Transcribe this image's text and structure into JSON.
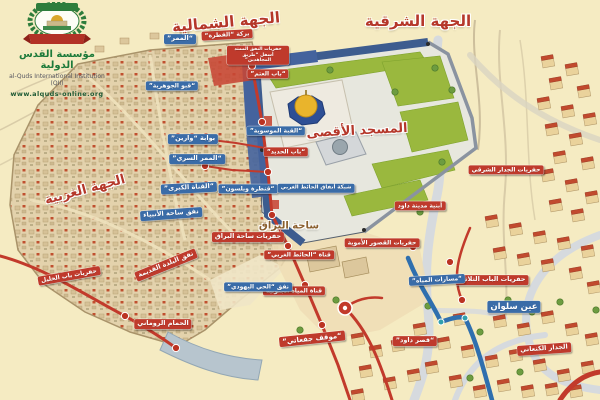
{
  "logo": {
    "org_name_ar": "مؤسسة القدس الدولية",
    "org_name_en": "al-Quds International Institution (QII)",
    "website": "www.alquds-online.org"
  },
  "headers": [
    {
      "id": "side-north",
      "text": "الجهة الشمالية",
      "x": 226,
      "y": 22,
      "rot": -5,
      "fs": 15
    },
    {
      "id": "side-east",
      "text": "الجهة الشرقية",
      "x": 418,
      "y": 21,
      "rot": 0,
      "fs": 15
    },
    {
      "id": "side-west",
      "text": "الجهة الغربية",
      "x": 85,
      "y": 190,
      "rot": -15,
      "fs": 13
    },
    {
      "id": "al-aqsa-mosque",
      "text": "المسجد الأقصى",
      "x": 357,
      "y": 131,
      "rot": -3,
      "fs": 13
    },
    {
      "id": "buraq-plaza",
      "text": "ساحة البراق",
      "x": 289,
      "y": 226,
      "rot": 0,
      "fs": 10,
      "color": "#8a5f2e"
    }
  ],
  "labels": [
    {
      "id": "birket-al-qatra",
      "text": "بركة “القطرة”",
      "color": "red",
      "x": 227,
      "y": 35,
      "rot": -3,
      "fs": 6
    },
    {
      "id": "north-tunnel-excavation",
      "text": "حفريات النفق الممتد أسفل “طريق المجاهدين”",
      "color": "red",
      "x": 258,
      "y": 55,
      "rot": 0,
      "fs": 4.6,
      "w": 56
    },
    {
      "id": "bab-al-atm",
      "text": "“باب العتم”",
      "color": "red",
      "x": 268,
      "y": 74,
      "rot": 0,
      "fs": 6
    },
    {
      "id": "bab-al-hadid",
      "text": "“باب الحديد”",
      "color": "red",
      "x": 286,
      "y": 152,
      "rot": 0,
      "fs": 6
    },
    {
      "id": "mosaic-dome",
      "text": "“القبة الموسوية”",
      "color": "blue",
      "x": 276,
      "y": 131,
      "rot": 0,
      "fs": 6
    },
    {
      "id": "buraq-plaza-excavations",
      "text": "حفريات ساحة البراق",
      "color": "red",
      "x": 248,
      "y": 237,
      "rot": 0,
      "fs": 6.5
    },
    {
      "id": "old-city-tunnel",
      "text": "نفق البلدة القديمة",
      "color": "red",
      "x": 166,
      "y": 265,
      "rot": -22,
      "fs": 6.5
    },
    {
      "id": "jaffa-gate-excavations",
      "text": "حفريات باب الخليل",
      "color": "red",
      "x": 69,
      "y": 276,
      "rot": -10,
      "fs": 6
    },
    {
      "id": "roman-bath",
      "text": "الحمام الروماني",
      "color": "red",
      "x": 163,
      "y": 324,
      "rot": 0,
      "fs": 6.5
    },
    {
      "id": "givati-parking",
      "text": "“موقف جفعاتي”",
      "color": "red",
      "x": 312,
      "y": 339,
      "rot": -6,
      "fs": 7
    },
    {
      "id": "david-palace",
      "text": "“قصر داود”",
      "color": "red",
      "x": 415,
      "y": 341,
      "rot": 0,
      "fs": 6.5
    },
    {
      "id": "triple-gate-excavations",
      "text": "حفريات الباب الثلاثي",
      "color": "red",
      "x": 492,
      "y": 280,
      "rot": 0,
      "fs": 6.5
    },
    {
      "id": "canaanite-wall",
      "text": "الجدار الكنعاني",
      "color": "red",
      "x": 544,
      "y": 349,
      "rot": -4,
      "fs": 6.5
    },
    {
      "id": "umayyad-palaces-excavations",
      "text": "حفريات القصور الأموية",
      "color": "red",
      "x": 382,
      "y": 243,
      "rot": 0,
      "fs": 6
    },
    {
      "id": "western-wall-channel",
      "text": "قناة “الحائط الغربي”",
      "color": "red",
      "x": 299,
      "y": 255,
      "rot": 0,
      "fs": 6
    },
    {
      "id": "southern-water-channel",
      "text": "قناة المياه الجنوبية",
      "color": "red",
      "x": 294,
      "y": 291,
      "rot": 0,
      "fs": 6
    },
    {
      "id": "city-of-david-buildings",
      "text": "أبنية مدينة داود",
      "color": "red",
      "x": 420,
      "y": 206,
      "rot": 0,
      "fs": 6
    },
    {
      "id": "eastern-wall-excavations",
      "text": "حفريات الجدار الشرقي",
      "color": "red",
      "x": 506,
      "y": 170,
      "rot": 0,
      "fs": 6
    },
    {
      "id": "al-mammar",
      "text": "“الممر”",
      "color": "blue",
      "x": 180,
      "y": 39,
      "rot": 0,
      "fs": 6.5
    },
    {
      "id": "jawhariyya-vault",
      "text": "“قبو الجوهرية”",
      "color": "blue",
      "x": 172,
      "y": 86,
      "rot": 0,
      "fs": 6
    },
    {
      "id": "warrens-gate",
      "text": "بوابة “وارين”",
      "color": "blue",
      "x": 193,
      "y": 139,
      "rot": 0,
      "fs": 6.5
    },
    {
      "id": "secret-passage",
      "text": "“الممر السري”",
      "color": "blue",
      "x": 197,
      "y": 159,
      "rot": 0,
      "fs": 6.5
    },
    {
      "id": "great-channel",
      "text": "“القناة الكبرى”",
      "color": "blue",
      "x": 189,
      "y": 188,
      "rot": -3,
      "fs": 6.5
    },
    {
      "id": "wilsons-arch",
      "text": "“قنطرة ويلسون”",
      "color": "blue",
      "x": 248,
      "y": 189,
      "rot": 0,
      "fs": 6
    },
    {
      "id": "prophets-plaza-tunnel",
      "text": "نفق ساحة الأنبياء",
      "color": "blue",
      "x": 171,
      "y": 214,
      "rot": -4,
      "fs": 6.5
    },
    {
      "id": "jewish-quarter-tunnel",
      "text": "نفق “الحي اليهودي”",
      "color": "blue",
      "x": 258,
      "y": 287,
      "rot": 0,
      "fs": 6
    },
    {
      "id": "western-wall-tunnels-network",
      "text": "شبكة أنفاق الحائط الغربي",
      "color": "blue",
      "x": 316,
      "y": 188,
      "rot": 0,
      "fs": 5.5
    },
    {
      "id": "ein-silwan",
      "text": "عين سلوان",
      "color": "blue",
      "x": 514,
      "y": 307,
      "rot": 0,
      "fs": 8.5
    },
    {
      "id": "water-channels",
      "text": "“مسارات المياه”",
      "color": "blue",
      "x": 437,
      "y": 280,
      "rot": -3,
      "fs": 6
    }
  ],
  "colors": {
    "red_label": "#bf3a2c",
    "blue_label": "#3a6ca8",
    "header_text": "#b5372a",
    "lawn_green": "#9ab83e",
    "wall_blue": "#3d5c8f",
    "dome_gold": "#e9b42c",
    "background": "#f5ebc2"
  }
}
